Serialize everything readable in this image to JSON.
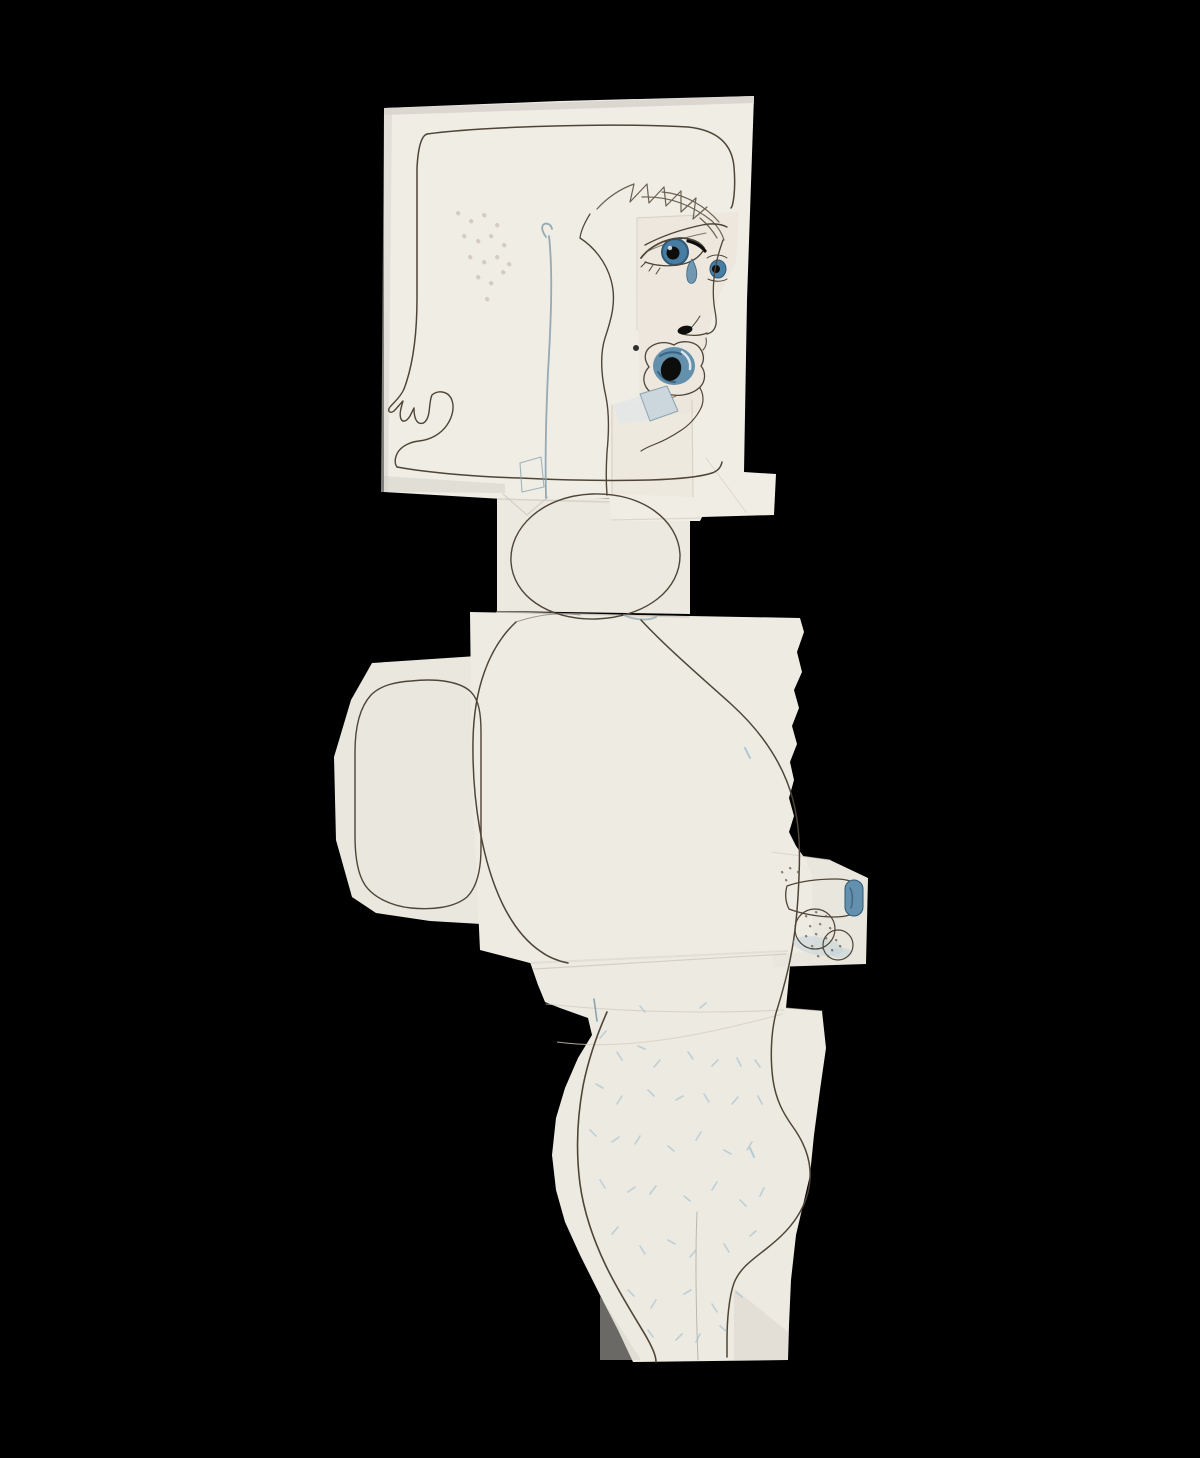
{
  "artwork": {
    "alt_text": "Photograph of a cut-and-pasted paper collage figure in profile, drawn in ink with blue watercolor details, on a black background",
    "pieces": [
      {
        "name": "head-sheet"
      },
      {
        "name": "neck-sheet"
      },
      {
        "name": "torso-sheet"
      },
      {
        "name": "left-arm-panel"
      },
      {
        "name": "hip-leg-sheet"
      },
      {
        "name": "crotch-patch"
      }
    ],
    "colors": {
      "background": "#000000",
      "paper_head": "#f0ede5",
      "paper_neck": "#ece9e1",
      "paper_torso": "#eeebe3",
      "paper_side": "#eae7df",
      "paper_hip": "#edeae1",
      "paper_patch": "#e9e6dd",
      "paper_edge": "#d9d6cf",
      "face_patch": "#e8e0d2",
      "jaw_patch": "#ece6db",
      "shadow": "#d6d2c9",
      "crease": "#cfc9bc",
      "tan_crease": "#d8cfc0",
      "ink": "#4e4537",
      "ink_soft": "#6a6252",
      "blue_iris": "#477ca3",
      "blue_deep": "#2e5978",
      "blue_mid": "#6390ac",
      "blue_pale": "#cbd7dc",
      "blue_faint": "#dfe6e8",
      "blue_wash": "#bfd2db",
      "blue_stubble": "#a3c1d2",
      "blue_line": "#8ba3b0",
      "black_detail": "#0d0d0c",
      "highlight": "#e9eff3",
      "freckle": "#b4a694",
      "stipple": "#6b6355"
    }
  }
}
